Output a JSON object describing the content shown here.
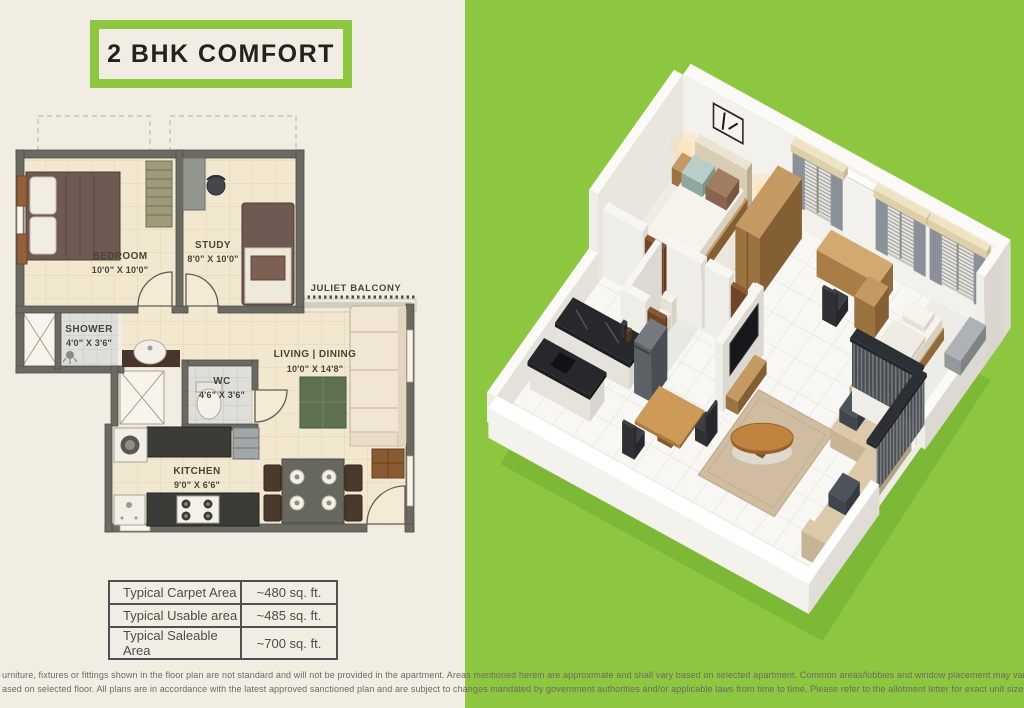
{
  "title_badge": {
    "label": "2 BHK COMFORT"
  },
  "colors": {
    "panel_green": "#8dc63f",
    "page_cream": "#f2ede2",
    "plan_wall": "#6b6a62",
    "plan_floor": "#f2e7cf",
    "label_text": "#4a443a",
    "table_border": "#4f5055",
    "table_text": "#4b4b4d",
    "disclaimer_text": "#6c6a66"
  },
  "floor_plan": {
    "balcony_label": "JULIET BALCONY",
    "rooms": [
      {
        "name": "BEDROOM",
        "dims": "10'0\" X 10'0\""
      },
      {
        "name": "STUDY",
        "dims": "8'0\" X 10'0\""
      },
      {
        "name": "SHOWER",
        "dims": "4'0\" X 3'6\""
      },
      {
        "name": "WC",
        "dims": "4'6\" X 3'6\""
      },
      {
        "name": "LIVING | DINING",
        "dims": "10'0\" X 14'8\""
      },
      {
        "name": "KITCHEN",
        "dims": "9'0\" X 6'6\""
      }
    ]
  },
  "area_table": {
    "rows": [
      {
        "label": "Typical Carpet Area",
        "value": "~480 sq. ft."
      },
      {
        "label": "Typical Usable area",
        "value": "~485 sq. ft."
      },
      {
        "label": "Typical Saleable Area",
        "value": "~700 sq. ft."
      }
    ]
  },
  "disclaimer": {
    "line1": "urniture, fixtures or fittings shown in the floor plan are not standard and will not be provided in the apartment. Areas mentioned herein are approximate and shall vary based on selected apartment. Common areas/lobbies and window placement may vary",
    "line2": "ased on selected floor. All plans are in accordance with the latest approved sanctioned plan and are subject to changes mandated by government authorities and/or applicable laws from time to time. Please refer to the allotment letter for exact unit sizes."
  }
}
